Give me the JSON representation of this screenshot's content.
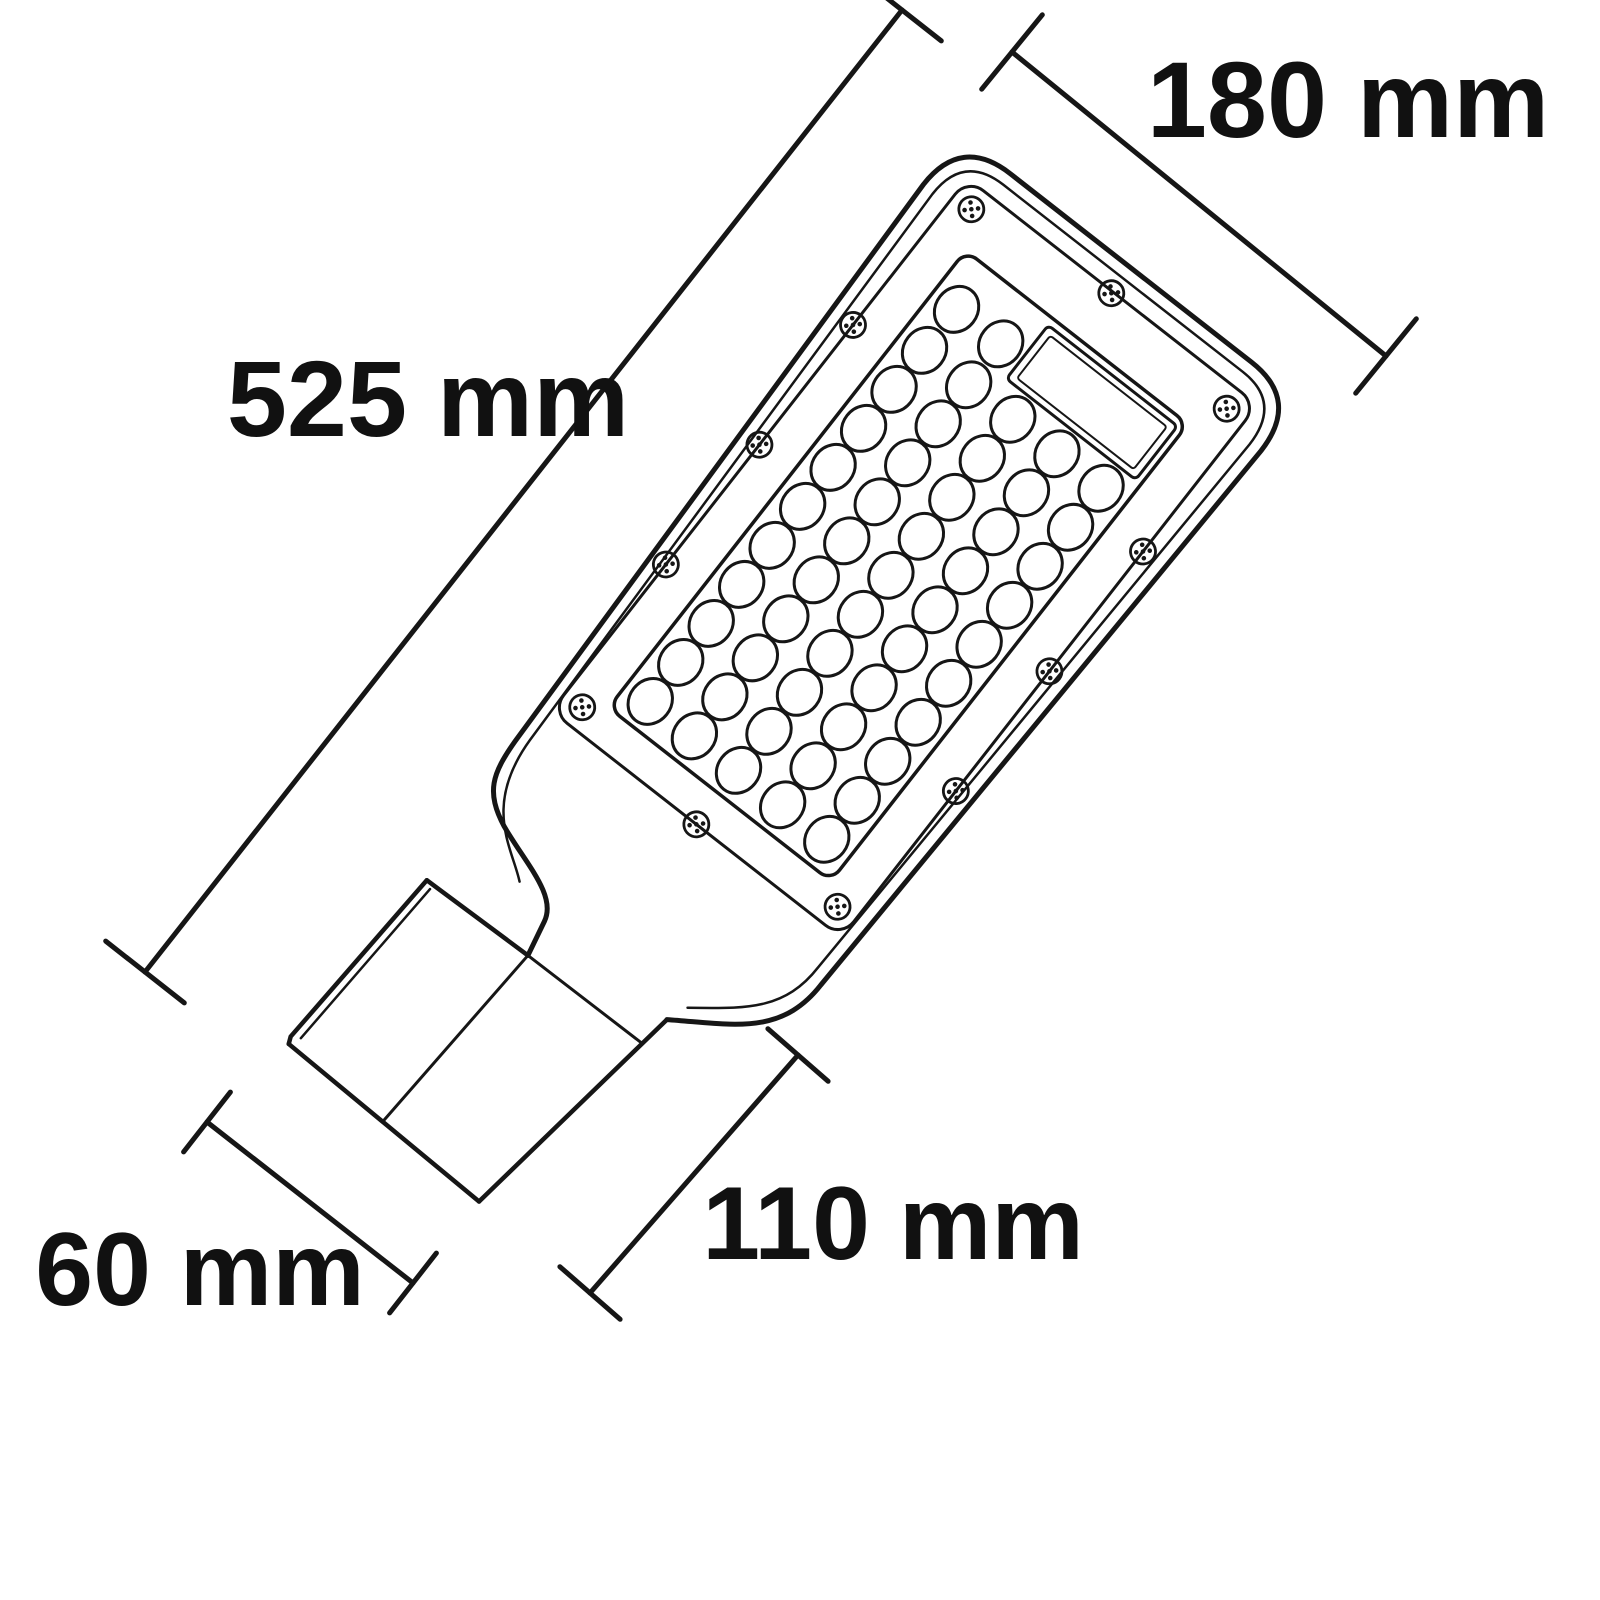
{
  "page": {
    "background": "#ffffff",
    "description": "Technical dimensional line drawing of an SMD LED street light head with pole-mount bracket, shown rotated diagonally"
  },
  "diagram": {
    "type": "technical-dimension-diagram",
    "object": "LED street light",
    "style": {
      "line_color": "#161616",
      "label_color": "#111111",
      "background": "#ffffff"
    },
    "labels": {
      "d525": "525 mm",
      "d180": "180 mm",
      "d110": "110 mm",
      "d60": "60 mm"
    },
    "dimensions": [
      {
        "id": "d525",
        "label": "525 mm",
        "value": 525,
        "unit": "mm",
        "measures": "overall length of the luminaire"
      },
      {
        "id": "d180",
        "label": "180 mm",
        "value": 180,
        "unit": "mm",
        "measures": "width of the lamp head"
      },
      {
        "id": "d110",
        "label": "110 mm",
        "value": 110,
        "unit": "mm",
        "measures": "length of the mounting tube"
      },
      {
        "id": "d60",
        "label": "60 mm",
        "value": 60,
        "unit": "mm",
        "measures": "width of the mounting tube"
      }
    ],
    "led_panel": {
      "lens_columns": 5,
      "lens_rows": 10,
      "top_partial_row_lenses": 2,
      "lens_count_visible": 52,
      "screw_count": 12,
      "window": "clear rectangular strip at head end of glass"
    }
  }
}
